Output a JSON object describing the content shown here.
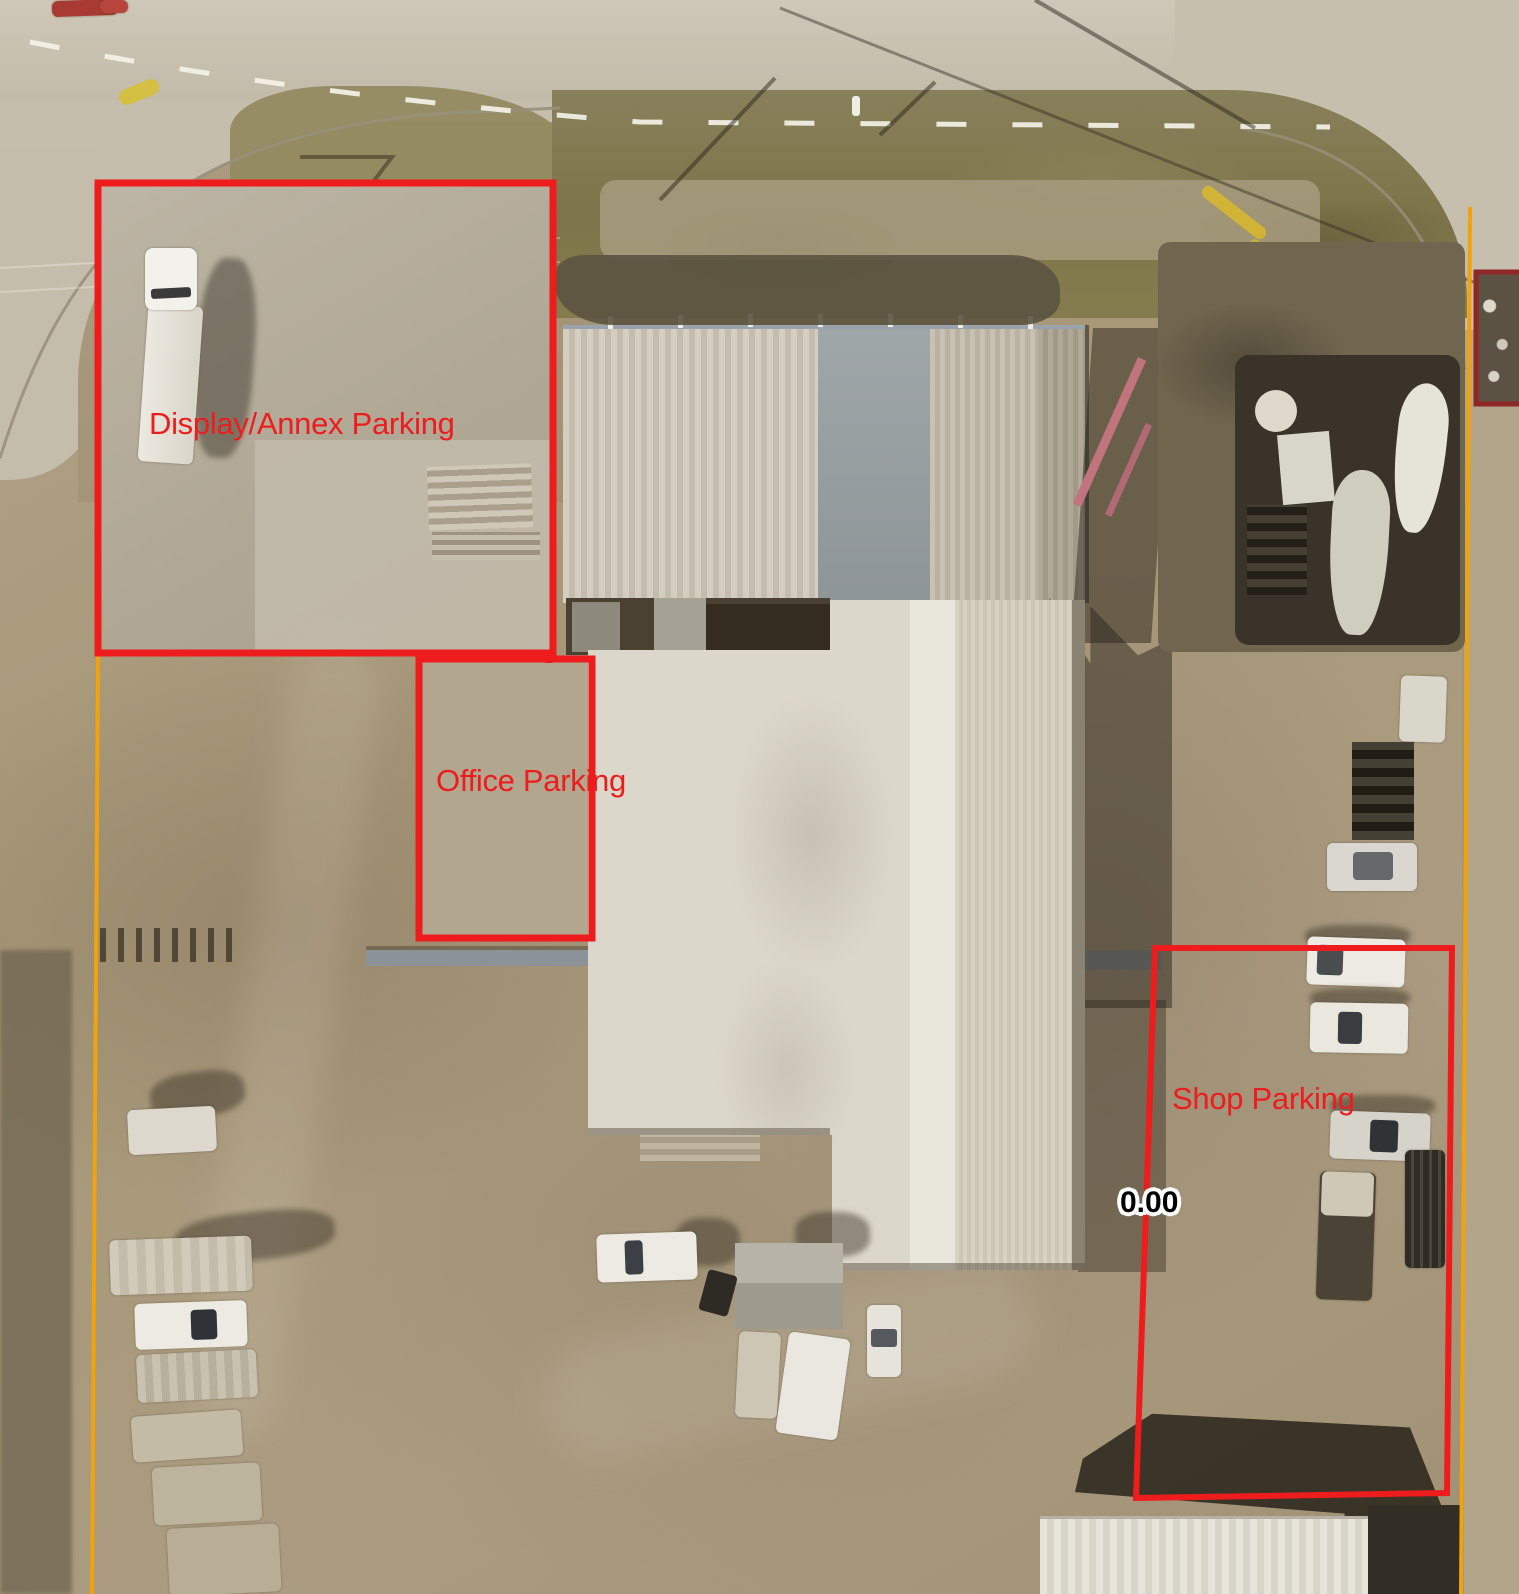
{
  "zones": {
    "display_annex": {
      "label": "Display/Annex Parking"
    },
    "office": {
      "label": "Office Parking"
    },
    "shop": {
      "label": "Shop Parking"
    }
  },
  "measurement": {
    "value": "0.00"
  },
  "colors": {
    "zone_outline": "#ee1c1c",
    "scrap_outline": "#8f2727",
    "boundary_line": "#f0a30a",
    "label_text": "#ee1c1c",
    "measurement_text": "#000000",
    "measurement_halo": "#ffffff"
  }
}
